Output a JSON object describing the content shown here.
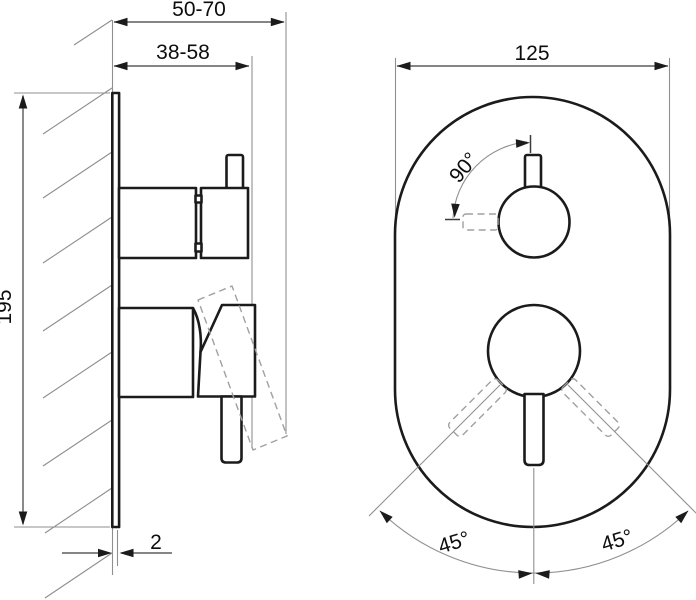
{
  "colors": {
    "background": "#ffffff",
    "object_line": "#1b1b1b",
    "dimension_line": "#3c3c3c",
    "construction_line": "#8f8f8f"
  },
  "side_view": {
    "dims": {
      "outer_depth": "50-70",
      "inner_depth": "38-58",
      "height": "195",
      "plate_thickness": "2"
    }
  },
  "front_view": {
    "dims": {
      "plate_width": "125",
      "thermostat_rotation": "90°",
      "lever_rotation_left": "45°",
      "lever_rotation_right": "45°"
    }
  }
}
